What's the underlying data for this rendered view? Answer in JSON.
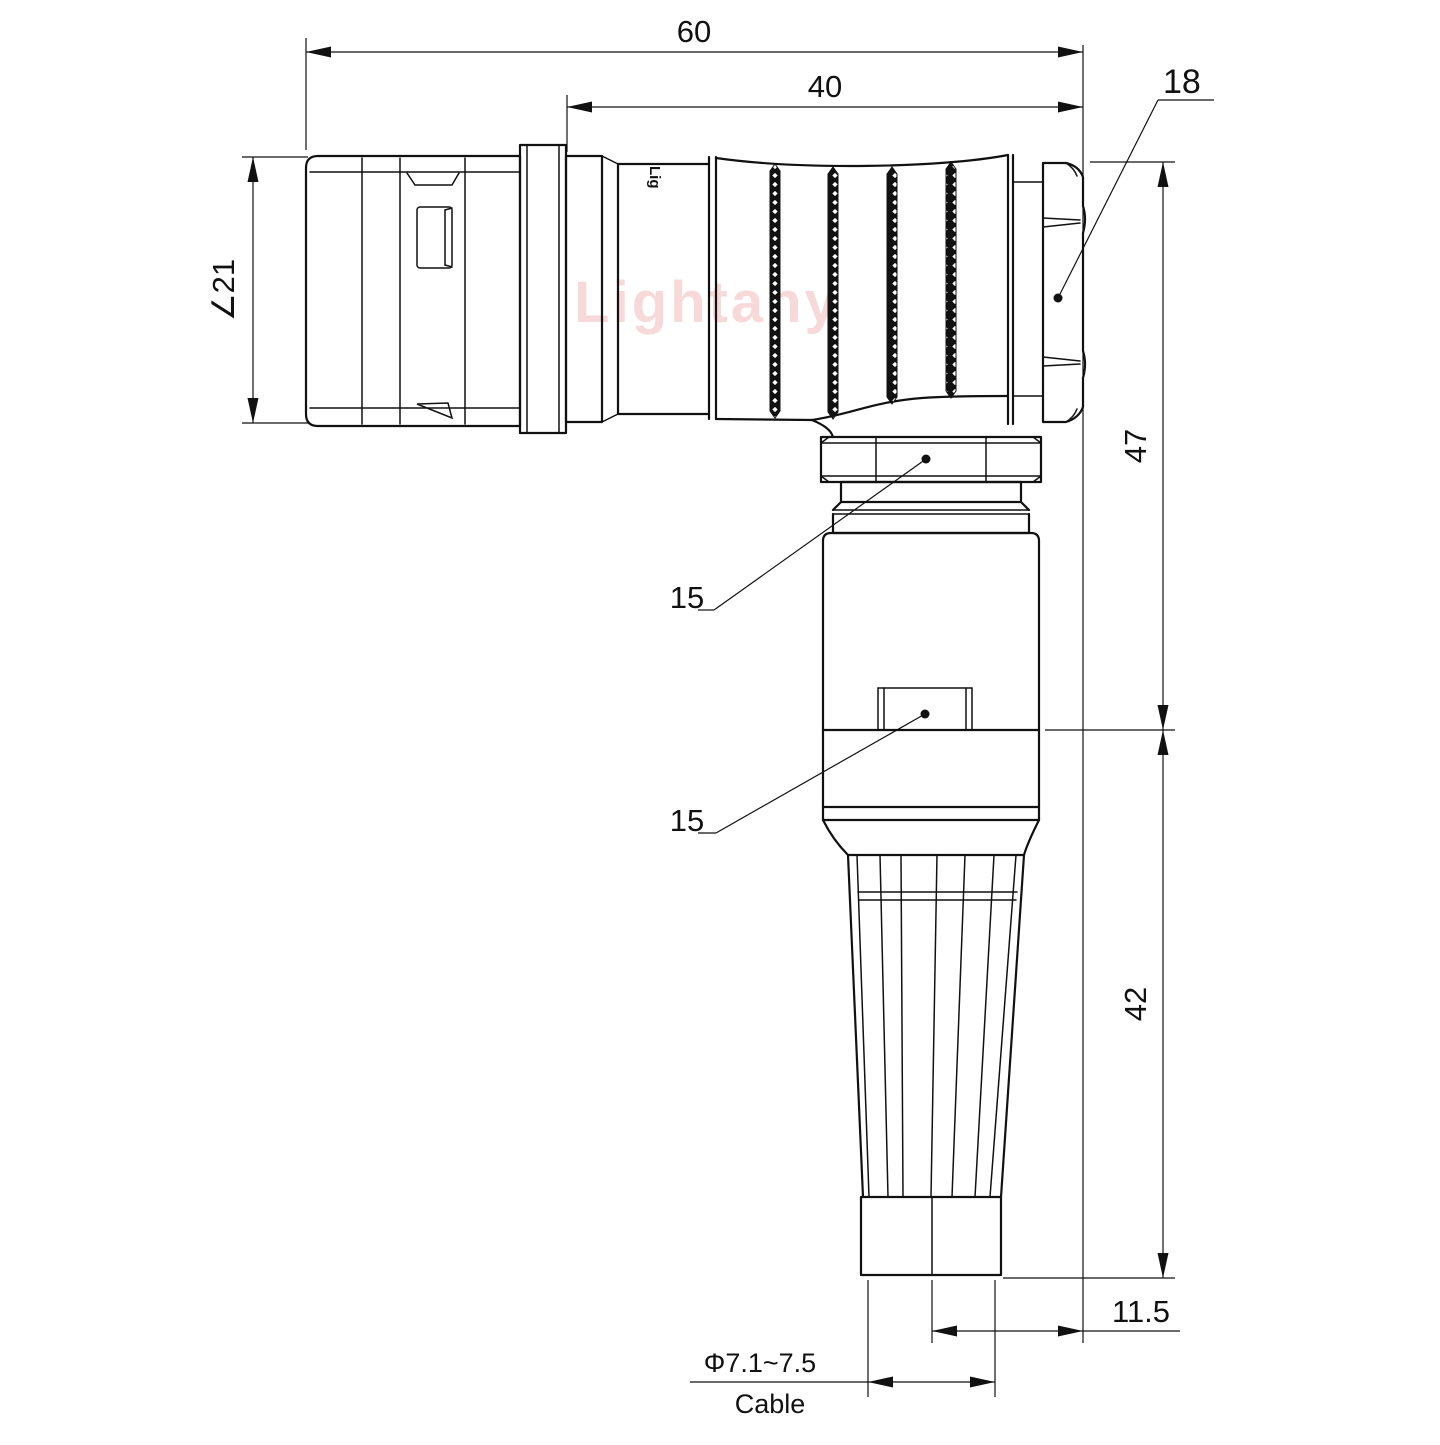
{
  "drawing": {
    "watermark": "Lightany",
    "part_marking": "Lig",
    "style": {
      "line_color": "#111111",
      "watermark_color": "#f1b4b4"
    },
    "dims": {
      "overall_length": "60",
      "rear_length": "40",
      "hex_across_flats": "18",
      "front_diameter": "∠21",
      "upper_height": "47",
      "lower_height": "42",
      "nut_size_upper": "15",
      "nut_size_lower": "15",
      "axis_offset": "11.5",
      "cable_diameter": "Φ7.1~7.5",
      "cable_label": "Cable"
    }
  }
}
